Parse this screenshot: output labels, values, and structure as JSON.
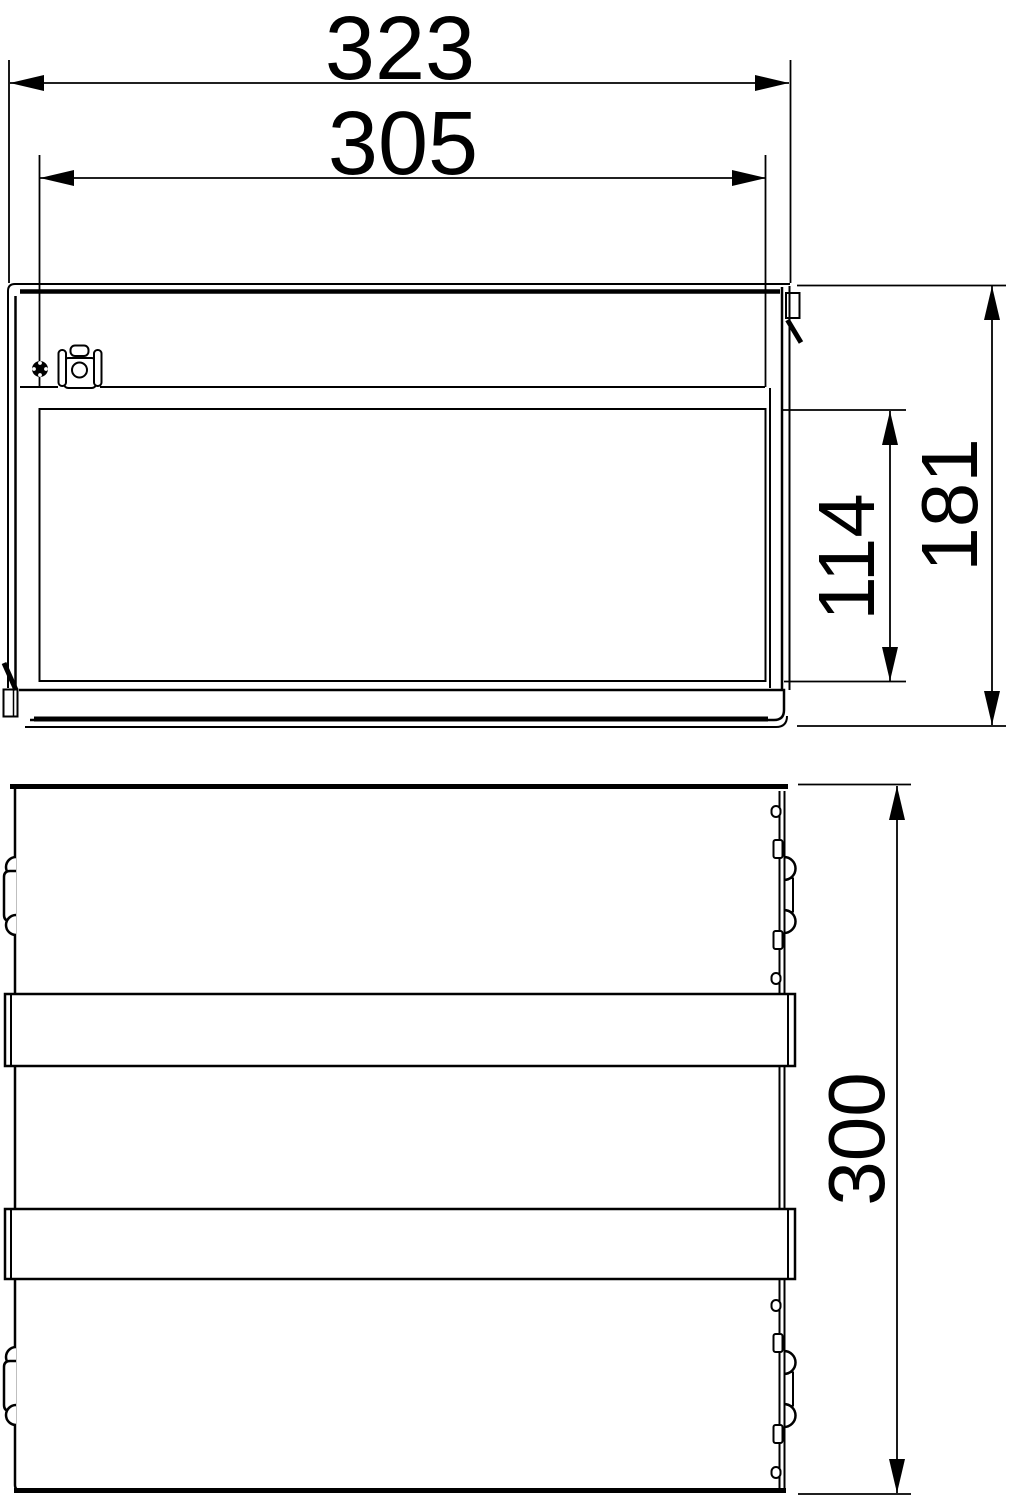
{
  "page": {
    "background": "#ffffff",
    "line_color": "#000000",
    "title": "Two-view enclosure dimension drawing"
  },
  "drawing": {
    "kind": "technical-dimension-drawing",
    "front_view": {
      "dims": {
        "overall_width": "323",
        "panel_width": "305",
        "panel_height": "114",
        "overall_height": "181"
      }
    },
    "side_view": {
      "dims": {
        "overall_depth": "300"
      }
    }
  }
}
